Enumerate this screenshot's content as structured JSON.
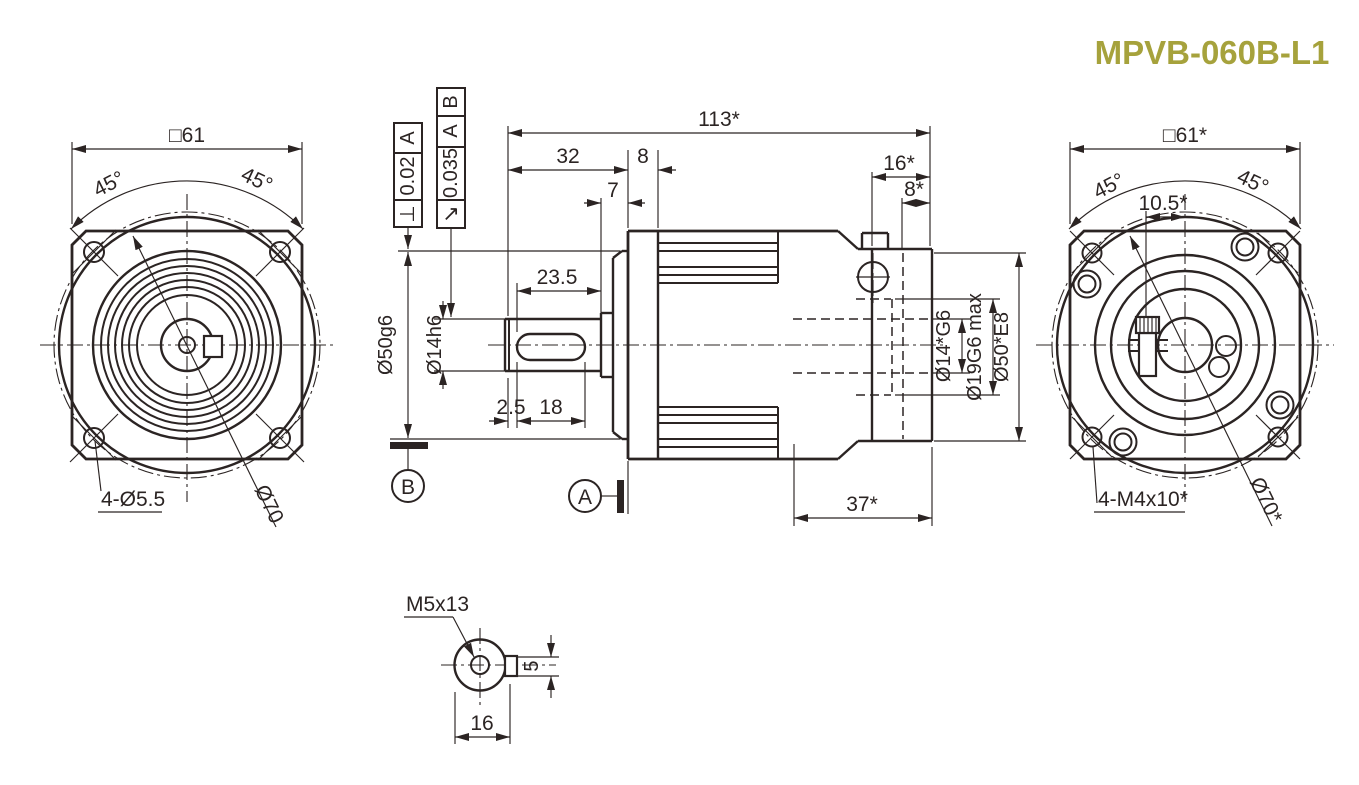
{
  "title": "MPVB-060B-L1",
  "front_view": {
    "dim_width": "□61",
    "angle_left": "45°",
    "angle_right": "45°",
    "holes_label": "4-Ø5.5",
    "bolt_circle_label": "Ø70"
  },
  "side_view": {
    "dim_overall": "113*",
    "dim_shaft_len": "32",
    "dim_flange_thk": "8",
    "dim_collar": "7",
    "dim_motor_side": "16*",
    "dim_motor_flange": "8*",
    "dim_keyway_full": "23.5",
    "dim_key_offset": "2.5",
    "dim_key_len": "18",
    "dim_rear_depth": "37*",
    "dia_pilot": "Ø50g6",
    "dia_shaft": "Ø14h6",
    "dia_bore": "Ø14*G6",
    "dia_bore_max": "Ø19G6 max",
    "dia_recess": "Ø50*E8",
    "datum_a": "A",
    "datum_b": "B",
    "fcf_perp": {
      "symbol": "⊥",
      "tolerance": "0.02",
      "datum": "A"
    },
    "fcf_runout": {
      "symbol": "↗",
      "tolerance": "0.035",
      "datum_1": "A",
      "datum_2": "B"
    }
  },
  "rear_view": {
    "dim_width": "□61*",
    "angle_left": "45°",
    "angle_right": "45°",
    "dim_screw_offset": "10.5*",
    "holes_label": "4-M4x10*",
    "bolt_circle_label": "Ø70*"
  },
  "shaft_end_view": {
    "thread_label": "M5x13",
    "dim_key_width": "5",
    "dim_across": "16"
  },
  "colors": {
    "line": "#2b2423",
    "title": "#a6a23c",
    "background": "#ffffff"
  }
}
